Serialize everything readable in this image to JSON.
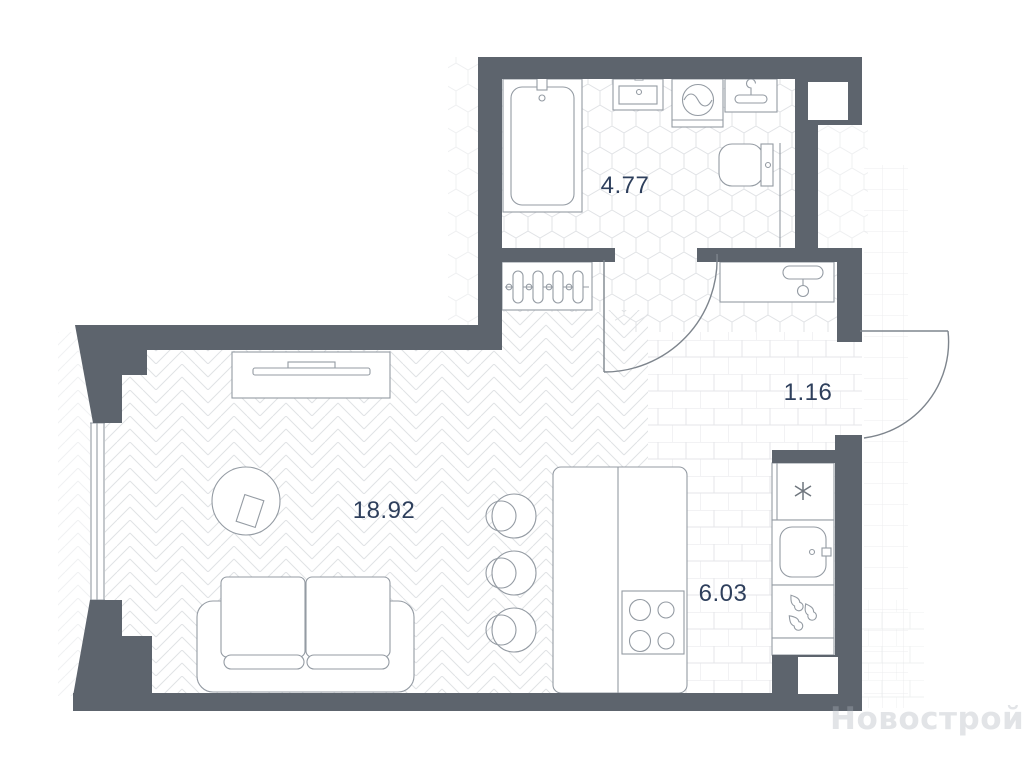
{
  "plan": {
    "type": "apartment-floor-plan",
    "watermark": {
      "text": "Новострой-М"
    },
    "rooms": {
      "bathroom": {
        "label": "4.77",
        "floor": "hexagon-tile",
        "fixtures": [
          "bathtub",
          "washbasin",
          "washing-machine",
          "towel-hanger",
          "toilet"
        ]
      },
      "hallway": {
        "label": "1.16",
        "floor": "brick-tile",
        "fixtures": [
          "radiator",
          "wardrobe-hanger",
          "entrance-door",
          "bathroom-door"
        ]
      },
      "living_room": {
        "label": "18.92",
        "floor": "herringbone-parquet",
        "fixtures": [
          "tv-console",
          "round-table",
          "sofa",
          "window"
        ]
      },
      "kitchen": {
        "label": "6.03",
        "floor": "brick-tile",
        "fixtures": [
          "bar-stools",
          "kitchen-island",
          "cooktop",
          "fridge",
          "kitchen-sink",
          "dishwasher"
        ]
      }
    },
    "colors": {
      "wall": "#5d646d",
      "fixture_line": "#949ba3",
      "door_line": "#7e858d",
      "label_text": "#2e3f5c",
      "pattern_line": "#e2e4e6",
      "background": "#ffffff"
    }
  }
}
